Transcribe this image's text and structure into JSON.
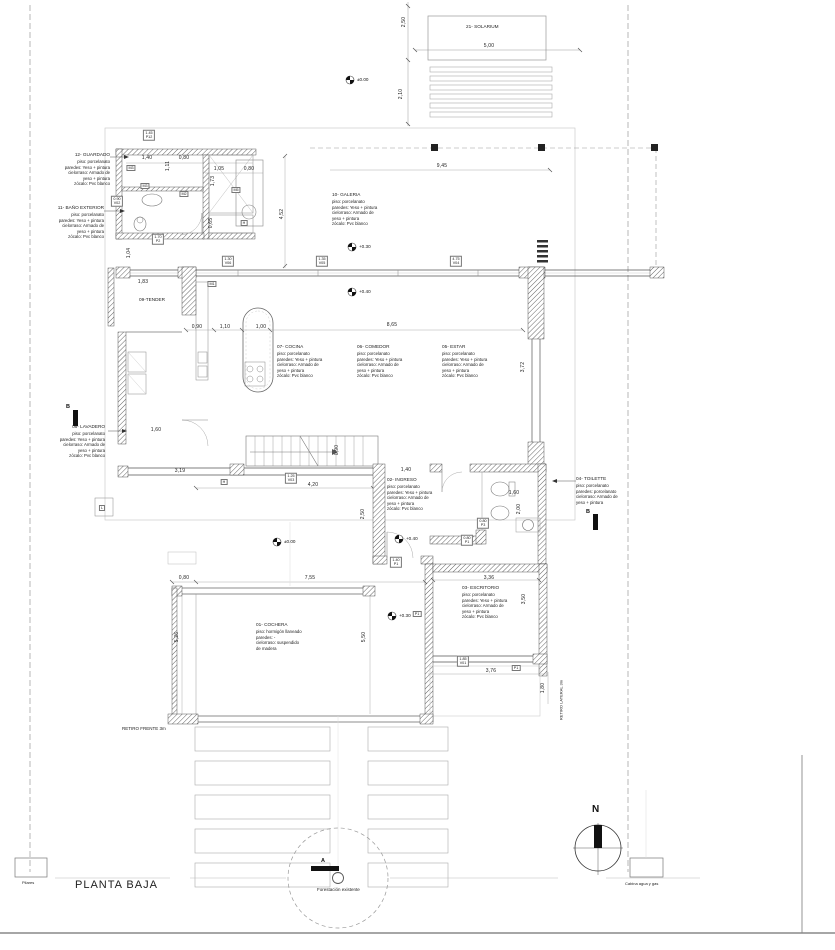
{
  "title": "PLANTA BAJA",
  "north_label": "N",
  "rooms": [
    {
      "name": "21- SOLARIUM",
      "specs": ""
    },
    {
      "name": "12- GUARDADO",
      "specs": "piso: porcelanato\nparedes: Yeso + pintura\ncielorraso: Armado de\nyeso + pintura\nzócalo: Pvc blanco"
    },
    {
      "name": "11- BAÑO EXTERIOR",
      "specs": "piso: porcelanato\nparedes: Yeso + pintura\ncielorraso: Armado de\nyeso + pintura\nzócalo: Pvc blanco"
    },
    {
      "name": "10- GALERIA",
      "specs": "piso: porcelanato\nparedes: Yeso + pintura\ncielorraso: Armado de\nyeso + pintura\nzócalo: Pvc blanco"
    },
    {
      "name": "07- COCINA",
      "specs": "piso: porcelanato\nparedes: Yeso + pintura\ncielorraso: Armado de\nyeso + pintura\nzócalo: Pvc blanco"
    },
    {
      "name": "06- COMEDOR",
      "specs": "piso: porcelanato\nparedes: Yeso + pintura\ncielorraso: Armado de\nyeso + pintura\nzócalo: Pvc blanco"
    },
    {
      "name": "05- ESTAR",
      "specs": "piso: porcelanato\nparedes: Yeso + pintura\ncielorraso: Armado de\nyeso + pintura\nzócalo: Pvc blanco"
    },
    {
      "name": "08- LAVADERO",
      "specs": "piso: porcelanato\nparedes: Yeso + pintura\ncielorraso: Armado de\nyeso + pintura\nzócalo: Pvc blanco"
    },
    {
      "name": "09-TENDER",
      "specs": ""
    },
    {
      "name": "02- INGRESO",
      "specs": "piso: porcelanato\nparedes: Yeso + pintura\ncielorraso: Armado de\nyeso + pintura\nzócalo: Pvc blanco"
    },
    {
      "name": "04- TOILETTE",
      "specs": "piso: porcelanato\nparedes: porcelanato\ncielorraso: Armado de\nyeso + pintura"
    },
    {
      "name": "03- ESCRITORIO",
      "specs": "piso: porcelanato\nparedes: Yeso + pintura\ncielorraso: Armado de\nyeso + pintura\nzócalo: Pvc blanco"
    },
    {
      "name": "01- COCHERA",
      "specs": "piso: hormigón llaneado\nparedes: -\ncielorraso: suspendido\nde madera"
    }
  ],
  "dimensions": [
    "2,50",
    "5,00",
    "2,10",
    "9,45",
    "1,40",
    "0,80",
    "1,05",
    "0,80",
    "1,11",
    "1,73",
    "0,65",
    "4,52",
    "1,83",
    "1,04",
    "0,90",
    "1,10",
    "1,00",
    "8,65",
    "3,72",
    "1,60",
    "3,19",
    "0,90",
    "4,20",
    "1,40",
    "2,50",
    "1,60",
    "2,00",
    "3,36",
    "3,50",
    "3,76",
    "1,80",
    "0,80",
    "7,55",
    "5,50",
    "5,26"
  ],
  "levels": [
    "±0.00",
    "+0.30",
    "+0.40",
    "+0.40",
    "±0.00",
    "+0.30"
  ],
  "tags": [
    {
      "value": "1.30",
      "code": "V06"
    },
    {
      "value": "1.35",
      "code": "V05"
    },
    {
      "value": "4.75",
      "code": "V04"
    },
    {
      "value": "1.25",
      "code": "V03"
    },
    {
      "value": "1.40",
      "code": "P1"
    },
    {
      "value": "0.80",
      "code": "P3"
    },
    {
      "value": "0.80",
      "code": "P1"
    },
    {
      "value": "1.85",
      "code": "V01"
    },
    {
      "value": "1.45",
      "code": "P12"
    },
    {
      "value": "1.70",
      "code": "P2"
    },
    {
      "value": "0.90",
      "code": "V02"
    }
  ],
  "wall_tags": [
    "M3",
    "M3",
    "M2",
    "M5",
    "M1",
    "H",
    "H",
    "L",
    "P1",
    "P1"
  ],
  "section_markers": [
    "A",
    "B",
    "B"
  ],
  "annotations": {
    "retiro_frente": "RETIRO FRENTE 3m",
    "retiro_lateral": "RETIRO LATERAL 3m",
    "forestacion": "Forestación existente",
    "pilares": "Pilares",
    "cabina": "Cabina agua y gas"
  }
}
